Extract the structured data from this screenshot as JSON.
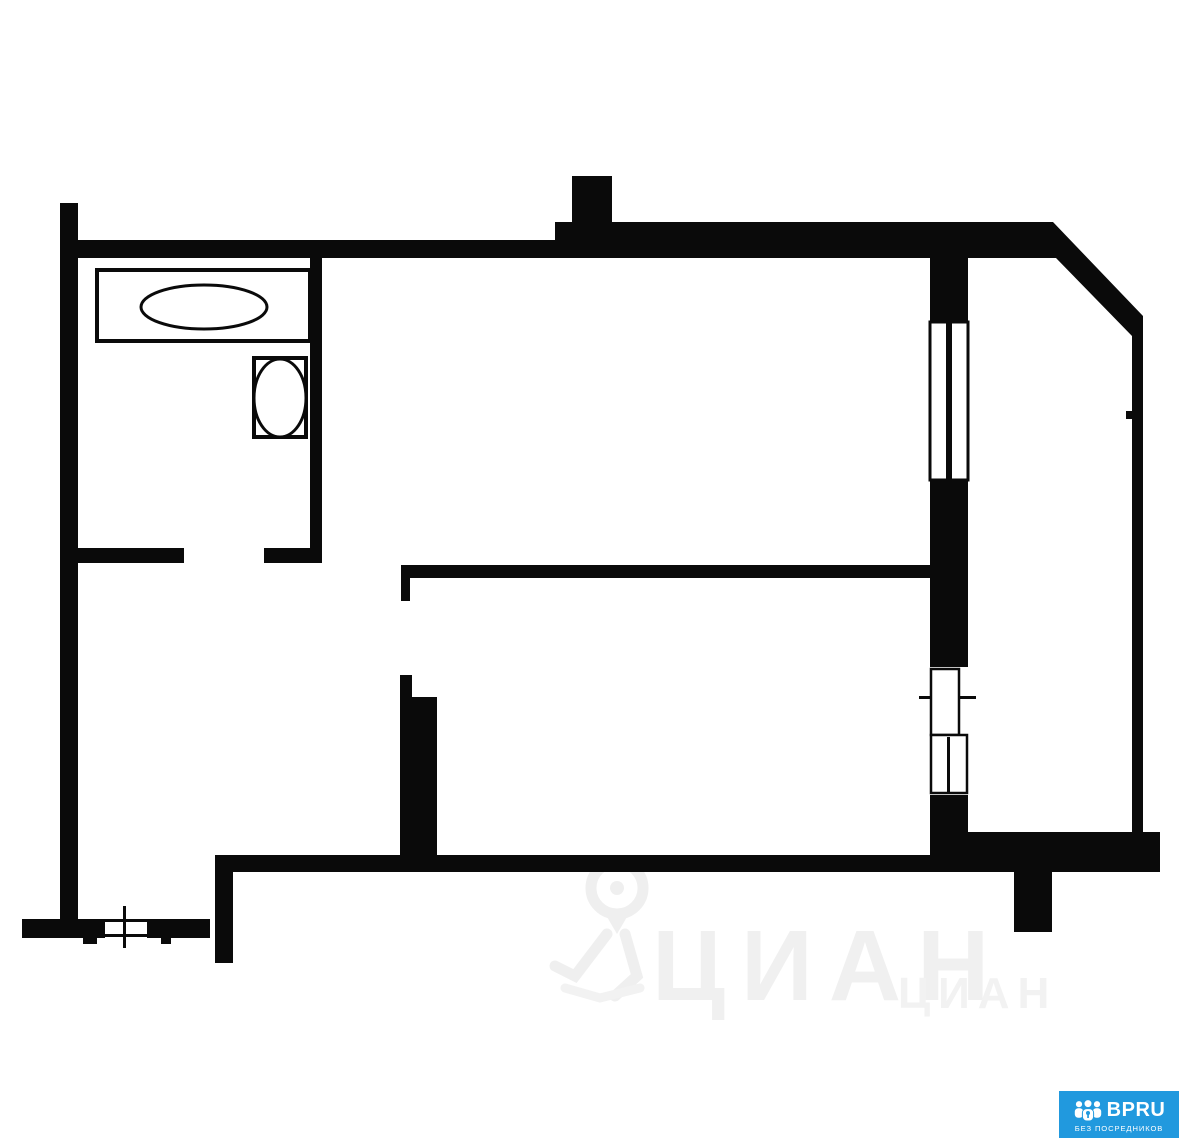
{
  "colors": {
    "wall": "#0a0a0a",
    "background": "#ffffff",
    "watermark": "#efefef",
    "logo_blue": "#2199de",
    "logo_text": "#ffffff"
  },
  "watermark": {
    "brand_large": "ЦИАН",
    "brand_small": "ЦИАН"
  },
  "logo": {
    "brand": "BPRU",
    "tagline": "БЕЗ ПОСРЕДНИКОВ"
  },
  "floorplan": {
    "shapes": [
      {
        "type": "rect",
        "name": "wall-left",
        "x": 60,
        "y": 203,
        "w": 18,
        "h": 717
      },
      {
        "type": "rect",
        "name": "wall-top-left",
        "x": 77,
        "y": 240,
        "w": 478,
        "h": 18
      },
      {
        "type": "rect",
        "name": "wall-top-right",
        "x": 555,
        "y": 222,
        "w": 498,
        "h": 36
      },
      {
        "type": "rect",
        "name": "wall-pilaster",
        "x": 572,
        "y": 176,
        "w": 40,
        "h": 46
      },
      {
        "type": "polygon",
        "name": "wall-corner-diagonal",
        "points": "1053,222 1143,316 1143,336 1132,336 1056,258 1053,258"
      },
      {
        "type": "rect",
        "name": "wall-right",
        "x": 1132,
        "y": 316,
        "w": 11,
        "h": 516
      },
      {
        "type": "rect",
        "name": "wall-right-tick",
        "x": 1126,
        "y": 411,
        "w": 6,
        "h": 8
      },
      {
        "type": "rect",
        "name": "wall-window-column-top",
        "x": 930,
        "y": 258,
        "w": 38,
        "h": 64
      },
      {
        "type": "rect",
        "name": "wall-window-column-mid",
        "x": 930,
        "y": 480,
        "w": 38,
        "h": 187
      },
      {
        "type": "rect",
        "name": "wall-window-column-bottom",
        "x": 930,
        "y": 795,
        "w": 38,
        "h": 60
      },
      {
        "type": "rect",
        "name": "wall-bathroom-right",
        "x": 310,
        "y": 258,
        "w": 12,
        "h": 305
      },
      {
        "type": "rect",
        "name": "wall-bathroom-bottom-left",
        "x": 75,
        "y": 548,
        "w": 109,
        "h": 15
      },
      {
        "type": "rect",
        "name": "wall-bathroom-bottom-right",
        "x": 264,
        "y": 548,
        "w": 58,
        "h": 15
      },
      {
        "type": "rect",
        "name": "wall-mid-horizontal",
        "x": 401,
        "y": 565,
        "w": 534,
        "h": 13
      },
      {
        "type": "rect",
        "name": "wall-mid-stub",
        "x": 401,
        "y": 565,
        "w": 9,
        "h": 36
      },
      {
        "type": "rect",
        "name": "wall-central-narrow",
        "x": 400,
        "y": 675,
        "w": 12,
        "h": 28
      },
      {
        "type": "rect",
        "name": "wall-central-wide",
        "x": 400,
        "y": 697,
        "w": 37,
        "h": 160
      },
      {
        "type": "rect",
        "name": "wall-bottom-main",
        "x": 217,
        "y": 855,
        "w": 751,
        "h": 17
      },
      {
        "type": "rect",
        "name": "wall-bottom-right",
        "x": 968,
        "y": 832,
        "w": 192,
        "h": 40
      },
      {
        "type": "rect",
        "name": "wall-bottom-left-vertical",
        "x": 215,
        "y": 855,
        "w": 18,
        "h": 108
      },
      {
        "type": "rect",
        "name": "wall-bottom-left-a",
        "x": 22,
        "y": 919,
        "w": 83,
        "h": 19
      },
      {
        "type": "rect",
        "name": "wall-bottom-left-b",
        "x": 147,
        "y": 919,
        "w": 63,
        "h": 19
      },
      {
        "type": "rect",
        "name": "wall-bottom-protrusion",
        "x": 1014,
        "y": 872,
        "w": 38,
        "h": 60
      },
      {
        "type": "rect",
        "name": "window-upper",
        "x": 930,
        "y": 322,
        "w": 38,
        "h": 158,
        "fill": "white",
        "stroke": 3
      },
      {
        "type": "rect",
        "name": "window-upper-mullion",
        "x": 946,
        "y": 322,
        "w": 6,
        "h": 158
      },
      {
        "type": "rect",
        "name": "balcony-sill-line",
        "x": 919,
        "y": 696,
        "w": 57,
        "h": 3
      },
      {
        "type": "rect",
        "name": "balcony-door-upper",
        "x": 931,
        "y": 669,
        "w": 28,
        "h": 66,
        "fill": "white",
        "stroke": 2.5
      },
      {
        "type": "rect",
        "name": "balcony-door-lower",
        "x": 931,
        "y": 735,
        "w": 36,
        "h": 58,
        "fill": "white",
        "stroke": 2.5
      },
      {
        "type": "rect",
        "name": "balcony-door-mullion",
        "x": 947,
        "y": 737,
        "w": 3,
        "h": 56
      },
      {
        "type": "rect",
        "name": "window-left-edge-top",
        "x": 105,
        "y": 919,
        "w": 42,
        "h": 3
      },
      {
        "type": "rect",
        "name": "window-left-edge-bottom",
        "x": 105,
        "y": 934,
        "w": 42,
        "h": 3
      },
      {
        "type": "rect",
        "name": "window-left-cross",
        "x": 123,
        "y": 906,
        "w": 3,
        "h": 42
      },
      {
        "type": "rect",
        "name": "window-left-tick-a",
        "x": 83,
        "y": 936,
        "w": 14,
        "h": 8
      },
      {
        "type": "rect",
        "name": "window-left-tick-b",
        "x": 161,
        "y": 936,
        "w": 10,
        "h": 8
      },
      {
        "type": "rect",
        "name": "bathtub",
        "x": 97,
        "y": 270,
        "w": 213,
        "h": 71,
        "fill": "white",
        "stroke": 4
      },
      {
        "type": "ellipse",
        "name": "bathtub-basin",
        "cx": 204,
        "cy": 307,
        "rx": 63,
        "ry": 22,
        "fill": "white",
        "stroke": 3
      },
      {
        "type": "rect",
        "name": "washbasin",
        "x": 254,
        "y": 358,
        "w": 52,
        "h": 79,
        "fill": "white",
        "stroke": 4
      },
      {
        "type": "ellipse",
        "name": "washbasin-bowl",
        "cx": 280,
        "cy": 398,
        "rx": 26,
        "ry": 39,
        "fill": "white",
        "stroke": 3
      }
    ]
  }
}
